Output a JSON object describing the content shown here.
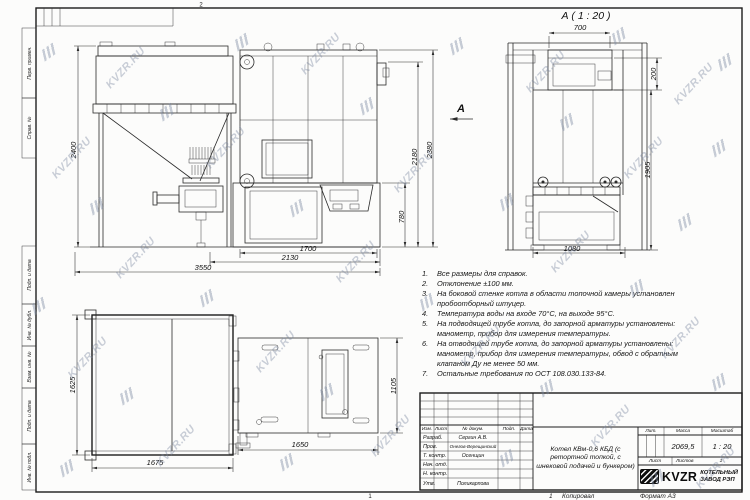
{
  "colors": {
    "line": "#2a2a2a",
    "watermark": "#7a88a0",
    "paper": "#fcfcfb"
  },
  "watermark": {
    "text": "KVZR.RU"
  },
  "frame": {
    "left_labels": [
      "Перв. примен.",
      "Справ. №",
      "Подп. и дата",
      "Инв. № дубл.",
      "Взам. инв. №",
      "Подп. и дата",
      "Инв. № подл."
    ],
    "zone_top": "2",
    "zone_bottom": "1"
  },
  "views": {
    "detail_label": "А ( 1 : 20 )",
    "arrow_label": "А"
  },
  "dims": {
    "side_height": "2400",
    "front_total_h": "2380",
    "front_body_h": "2180",
    "front_base_h": "780",
    "front_w1": "1700",
    "front_w2": "2130",
    "front_total_w": "3550",
    "rear_top_w": "700",
    "rear_top_h": "200",
    "rear_h": "1905",
    "rear_w": "1080",
    "plan_bunker_d": "1625",
    "plan_bunker_w": "1675",
    "plan_boiler_w": "1650",
    "plan_boiler_d": "1105"
  },
  "notes": [
    {
      "n": "1.",
      "text": "Все размеры для справок."
    },
    {
      "n": "2.",
      "text": "Отклонение ±100 мм."
    },
    {
      "n": "3.",
      "text": "На боковой стенке котла в области топочной камеры установлен пробоотборный штуцер."
    },
    {
      "n": "4.",
      "text": "Температура воды на входе 70°С, на выходе 95°С."
    },
    {
      "n": "5.",
      "text": "На подводящей трубе котла, до запорной арматуры установлены: манометр, прибор для измерения температуры."
    },
    {
      "n": "6.",
      "text": "На отводящей трубе котла, до запорной арматуры установлены: манометр, прибор для измерения температуры, обвод с обратным клапаном Ду не менее 50 мм."
    },
    {
      "n": "7.",
      "text": "Остальные требования по ОСТ 108.030.133-84."
    }
  ],
  "title_block": {
    "header_cols": [
      "Изм.",
      "Лист",
      "№ докум.",
      "Подп.",
      "Дата"
    ],
    "rows": [
      {
        "role": "Разраб.",
        "name": "Сергин А.В."
      },
      {
        "role": "Пров.",
        "name": "Онегов-Верещинский"
      },
      {
        "role": "Т. контр.",
        "name": "Осенщин"
      },
      {
        "role": "Нач. отд.",
        "name": ""
      },
      {
        "role": "Н. контр.",
        "name": ""
      },
      {
        "role": "Утв.",
        "name": "Поликарпова"
      }
    ],
    "title": "Котел КВм-0,6 КБД (с ретортной топкой, с шнековой подачей и бункером)",
    "lit_label": "Лит.",
    "mass_label": "Масса",
    "scale_label": "Масштаб",
    "mass_value": "2069,5",
    "scale_value": "1 : 20",
    "sheet_label": "Лист",
    "sheets_label": "Листов",
    "sheets_value": "1",
    "logo_text": "KVZR",
    "company_line1": "КОТЕЛЬНЫЙ",
    "company_line2": "ЗАВОД РЭП"
  },
  "footer": {
    "num": "1",
    "copied": "Копировал",
    "format": "Формат А3"
  }
}
